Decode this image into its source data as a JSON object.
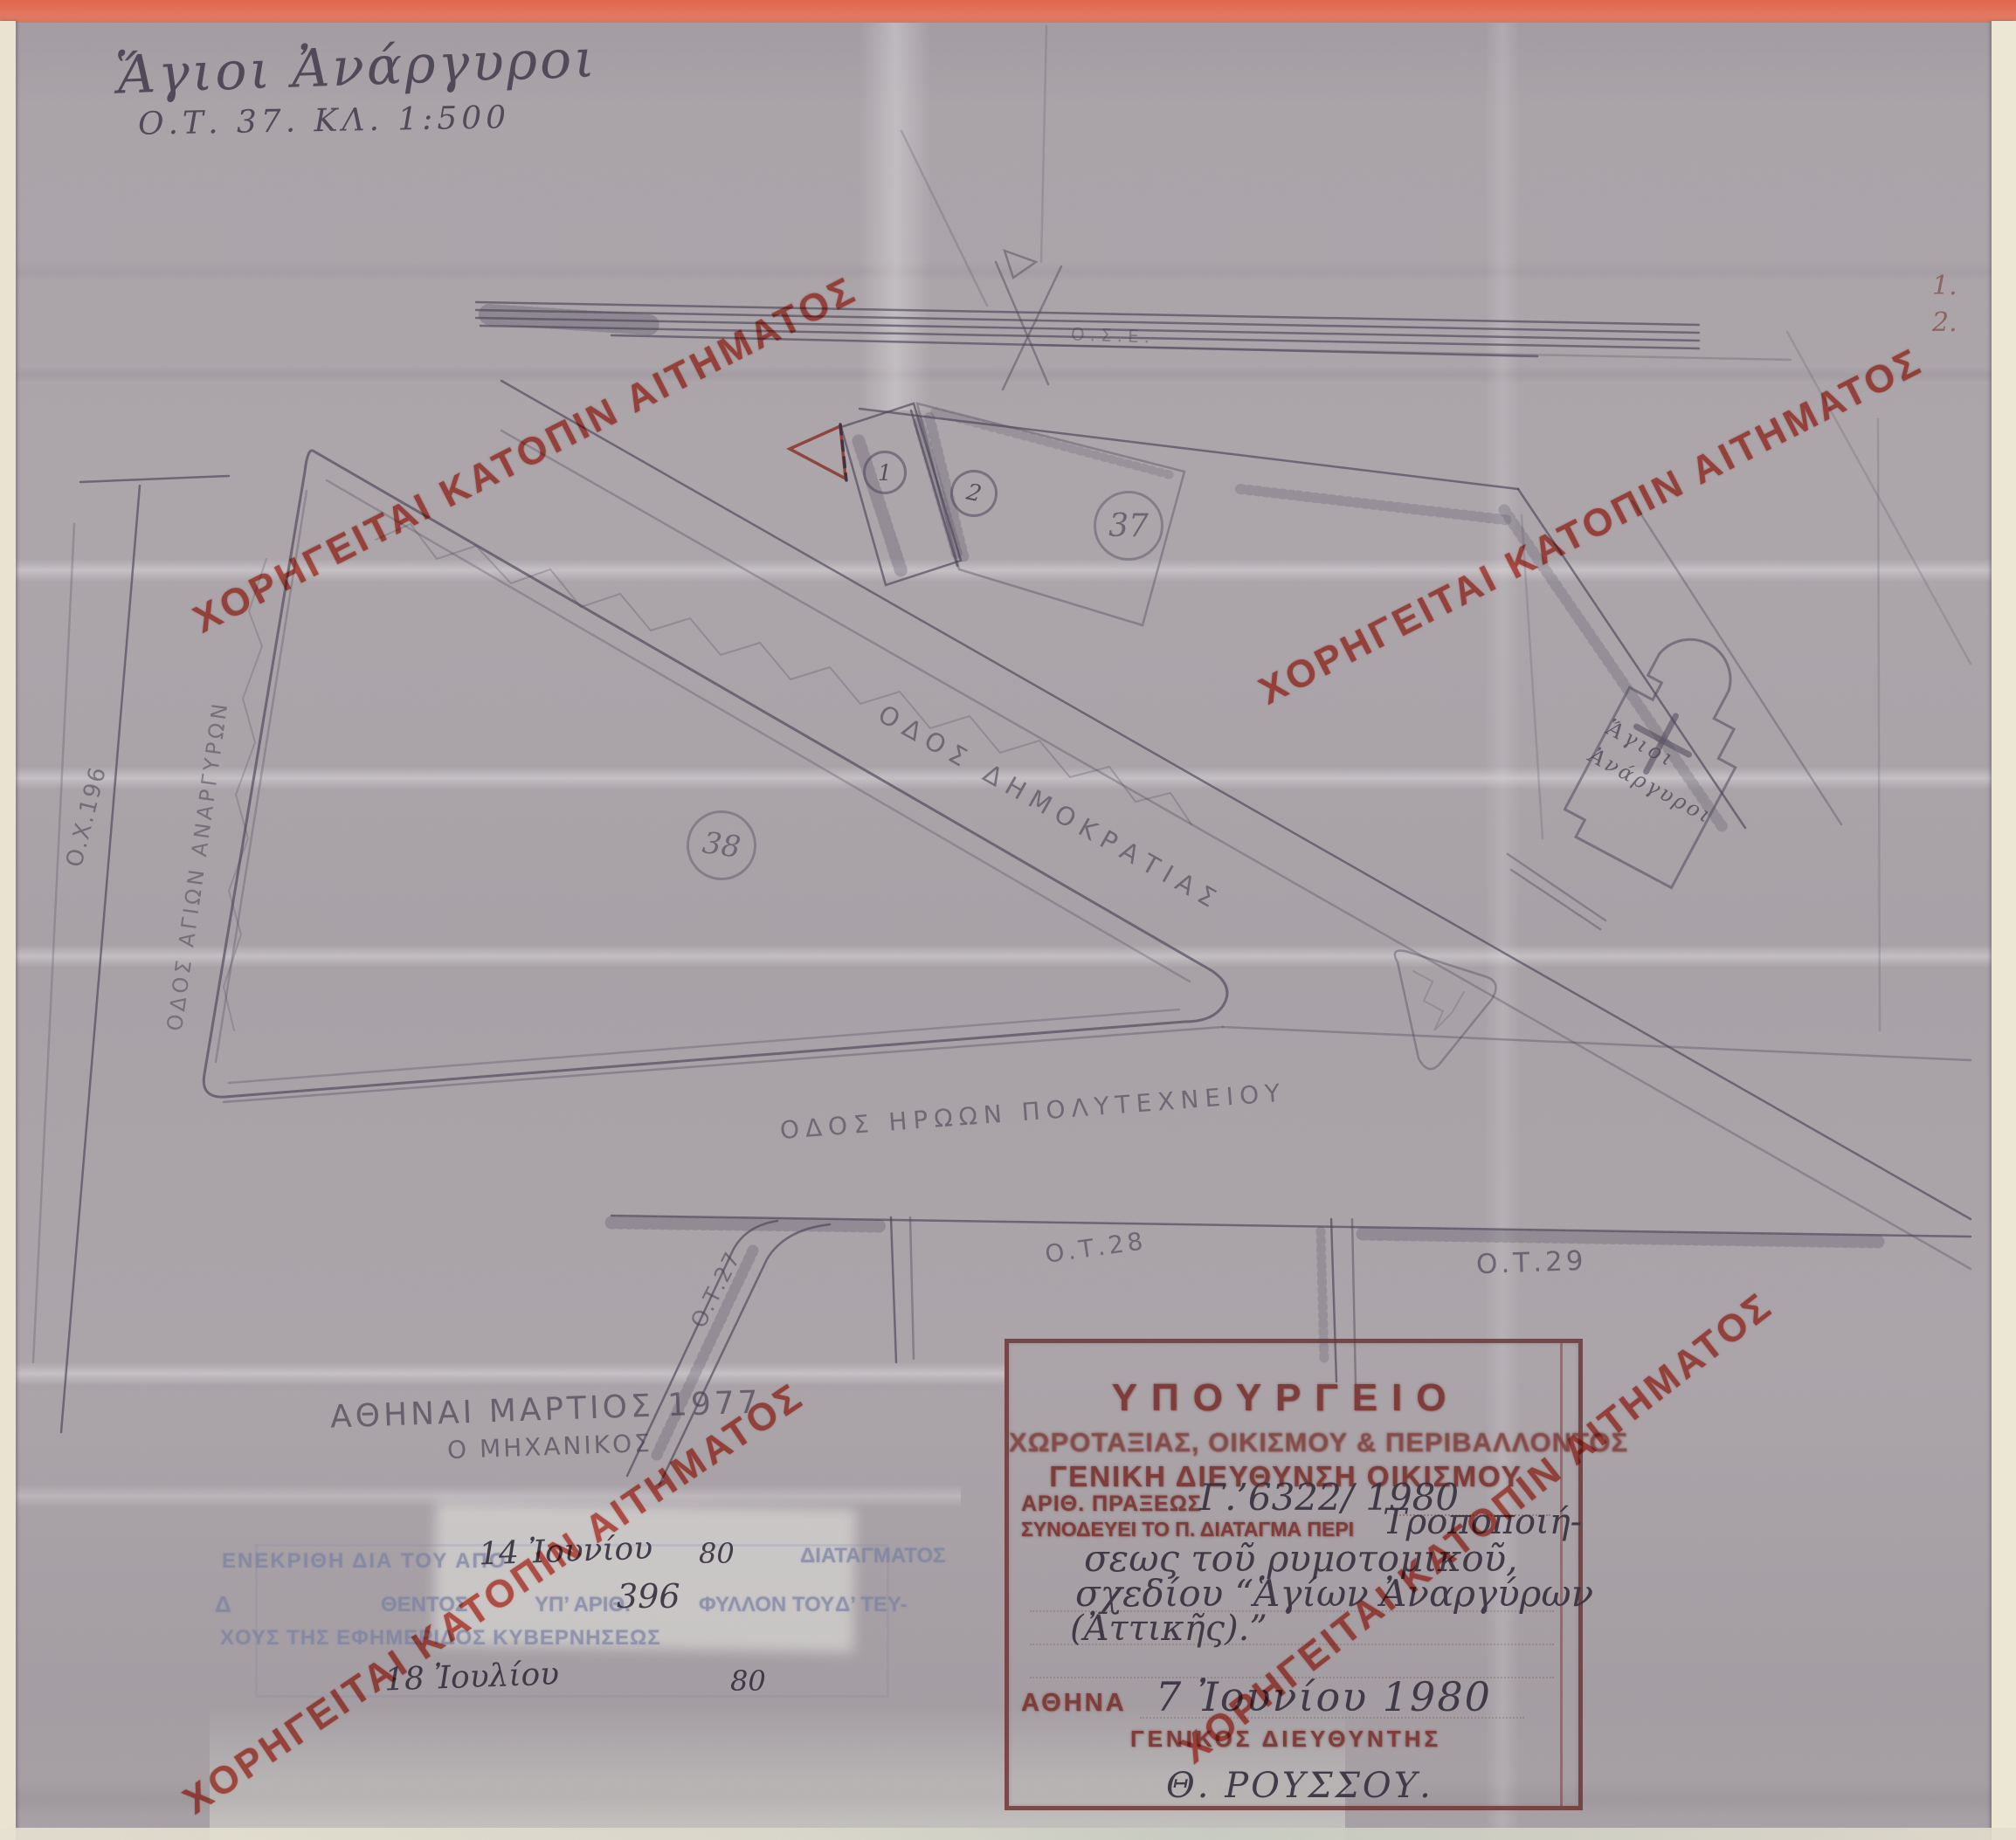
{
  "note": {
    "line1": "Ἅγιοι Ἀνάργυροι",
    "line2": "Ο.Τ. 37.   ΚΛ. 1:500"
  },
  "watermark": {
    "text": "ΧΟΡΗΓΕΙΤΑΙ ΚΑΤΟΠΙΝ ΑΙΤΗΜΑΤΟΣ",
    "color": "#d23b2c"
  },
  "margin_numbers": {
    "n1": "1.",
    "n2": "2."
  },
  "map": {
    "railway_label": "Ο.Σ.Ε.",
    "streets": {
      "dimokratias": "ΟΔΟΣ ΔΗΜΟΚΡΑΤΙΑΣ",
      "iroon": "ΟΔΟΣ ΗΡΩΩΝ ΠΟΛΥΤΕΧΝΕΙΟΥ",
      "agion": "ΟΔΟΣ ΑΓΙΩΝ ΑΝΑΡΓΥΡΩΝ"
    },
    "blocks": {
      "plot1": "1",
      "plot2": "2",
      "b37": "37",
      "b38": "38",
      "ot27": "Ο.Τ.27",
      "ot28": "Ο.Τ.28",
      "ot29": "Ο.Τ.29",
      "ox196": "Ο.Χ.196"
    },
    "church": {
      "line1": "Ἅγιοι",
      "line2": "Ἀνάργυροι"
    }
  },
  "engineer_note": {
    "line1": "ΑΘΗΝΑΙ ΜΑΡΤΙΟΣ 1977",
    "line2": "Ο ΜΗΧΑΝΙΚΟΣ"
  },
  "approval": {
    "faint1a": "ΕΝΕΚΡΙΘΗ ΔΙΑ ΤΟΥ ΑΠΟ",
    "hand_date1": "14 Ἰουνίου",
    "hand_year1": "80",
    "faint1b": "ΔΙΑΤΑΓΜΑΤΟΣ",
    "faint2a": "Δ",
    "faint2b": "ΘΕΝΤΟΣ",
    "faint2c": "ΥΠ’ ΑΡΙΘ.",
    "hand_number": "396",
    "faint2d": "ΦΥΛΛΟΝ ΤΟΥ",
    "faint2e": "Δ’ ΤΕΥ-",
    "faint3": "ΧΟΥΣ ΤΗΣ ΕΦΗΜΕΡΙΔΟΣ ΚΥΒΕΡΝΗΣΕΩΣ",
    "hand_date2": "18 Ἰουλίου",
    "hand_year2": "80"
  },
  "stamp": {
    "line1": "ΥΠΟΥΡΓΕΙΟ",
    "line2": "ΧΩΡΟΤΑΞΙΑΣ, ΟΙΚΙΣΜΟΥ & ΠΕΡΙΒΑΛΛΟΝΤΟΣ",
    "line3": "ΓΕΝΙΚΗ ΔΙΕΥΘΥΝΣΗ ΟΙΚΙΣΜΟΥ",
    "act_label": "ΑΡΙΘ. ΠΡΑΞΕΩΣ",
    "act_value": "Γ.’6322/ 1980",
    "decree_label": "ΣΥΝΟΔΕΥΕΙ ΤΟ Π. ΔΙΑΤΑΓΜΑ ΠΕΡΙ",
    "subject1": "Τροποποιή-",
    "subject2": "σεως τοῦ ρυμοτομικοῦ,",
    "subject3": "σχεδίου “Ἁγίων Ἀναργύρων",
    "subject4": "(Ἀττικῆς).”",
    "city_label": "ΑΘΗΝΑ",
    "date_value": "7 Ἰουνίου 1980",
    "signer_title": "ΓΕΝΙΚΟΣ ΔΙΕΥΘΥΝΤΗΣ",
    "signature": "Θ. ΡΟΥΣΣΟΥ."
  }
}
